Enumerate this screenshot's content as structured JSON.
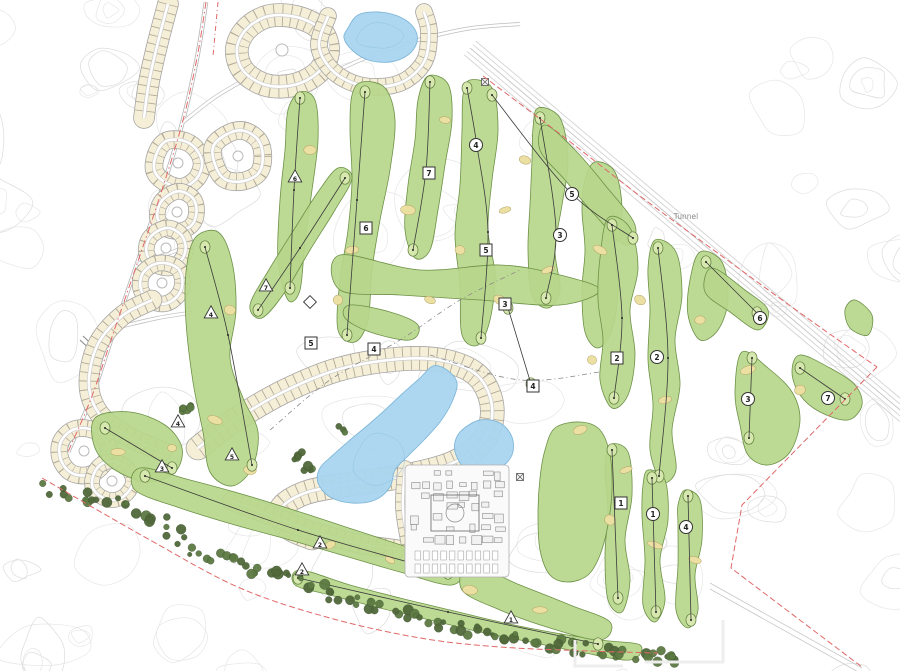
{
  "map": {
    "tunnel_label": "Tunnel",
    "colors": {
      "fairway": "#b7d78b",
      "fairway_outline": "#6d9147",
      "green_spot": "#d7e8af",
      "lake": "#a9d5f0",
      "lake_outline": "#7ab4d8",
      "lot_fill": "#f6efd8",
      "lot_line": "#a79f8d",
      "tree_dark": "#51683a",
      "tree_mid": "#5d7a43",
      "boundary_red": "#e06868",
      "contour_gray": "#e6e6e6",
      "bunker": "#ecdfa2",
      "marker_stroke": "#333333"
    },
    "markers": {
      "circles": [
        {
          "x": 476,
          "y": 145,
          "label": "4"
        },
        {
          "x": 572,
          "y": 194,
          "label": "5"
        },
        {
          "x": 560,
          "y": 235,
          "label": "3"
        },
        {
          "x": 657,
          "y": 357,
          "label": "2"
        },
        {
          "x": 653,
          "y": 514,
          "label": "1"
        },
        {
          "x": 686,
          "y": 527,
          "label": "4"
        },
        {
          "x": 760,
          "y": 318,
          "label": "6"
        },
        {
          "x": 748,
          "y": 399,
          "label": "3"
        },
        {
          "x": 828,
          "y": 398,
          "label": "7"
        }
      ],
      "squares": [
        {
          "x": 429,
          "y": 173,
          "label": "7"
        },
        {
          "x": 366,
          "y": 228,
          "label": "6"
        },
        {
          "x": 486,
          "y": 250,
          "label": "5"
        },
        {
          "x": 505,
          "y": 304,
          "label": "3"
        },
        {
          "x": 617,
          "y": 358,
          "label": "2"
        },
        {
          "x": 533,
          "y": 386,
          "label": "4"
        },
        {
          "x": 374,
          "y": 349,
          "label": "4"
        },
        {
          "x": 311,
          "y": 343,
          "label": "5"
        },
        {
          "x": 621,
          "y": 503,
          "label": "1"
        }
      ],
      "triangles": [
        {
          "x": 295,
          "y": 177,
          "label": "6"
        },
        {
          "x": 266,
          "y": 286,
          "label": "7"
        },
        {
          "x": 211,
          "y": 313,
          "label": "4"
        },
        {
          "x": 178,
          "y": 422,
          "label": "4"
        },
        {
          "x": 162,
          "y": 467,
          "label": "3"
        },
        {
          "x": 232,
          "y": 455,
          "label": "5"
        },
        {
          "x": 320,
          "y": 543,
          "label": "2"
        },
        {
          "x": 302,
          "y": 570,
          "label": "2"
        },
        {
          "x": 511,
          "y": 618,
          "label": "1"
        }
      ],
      "diamonds": [
        {
          "x": 310,
          "y": 302,
          "label": ""
        }
      ]
    }
  }
}
